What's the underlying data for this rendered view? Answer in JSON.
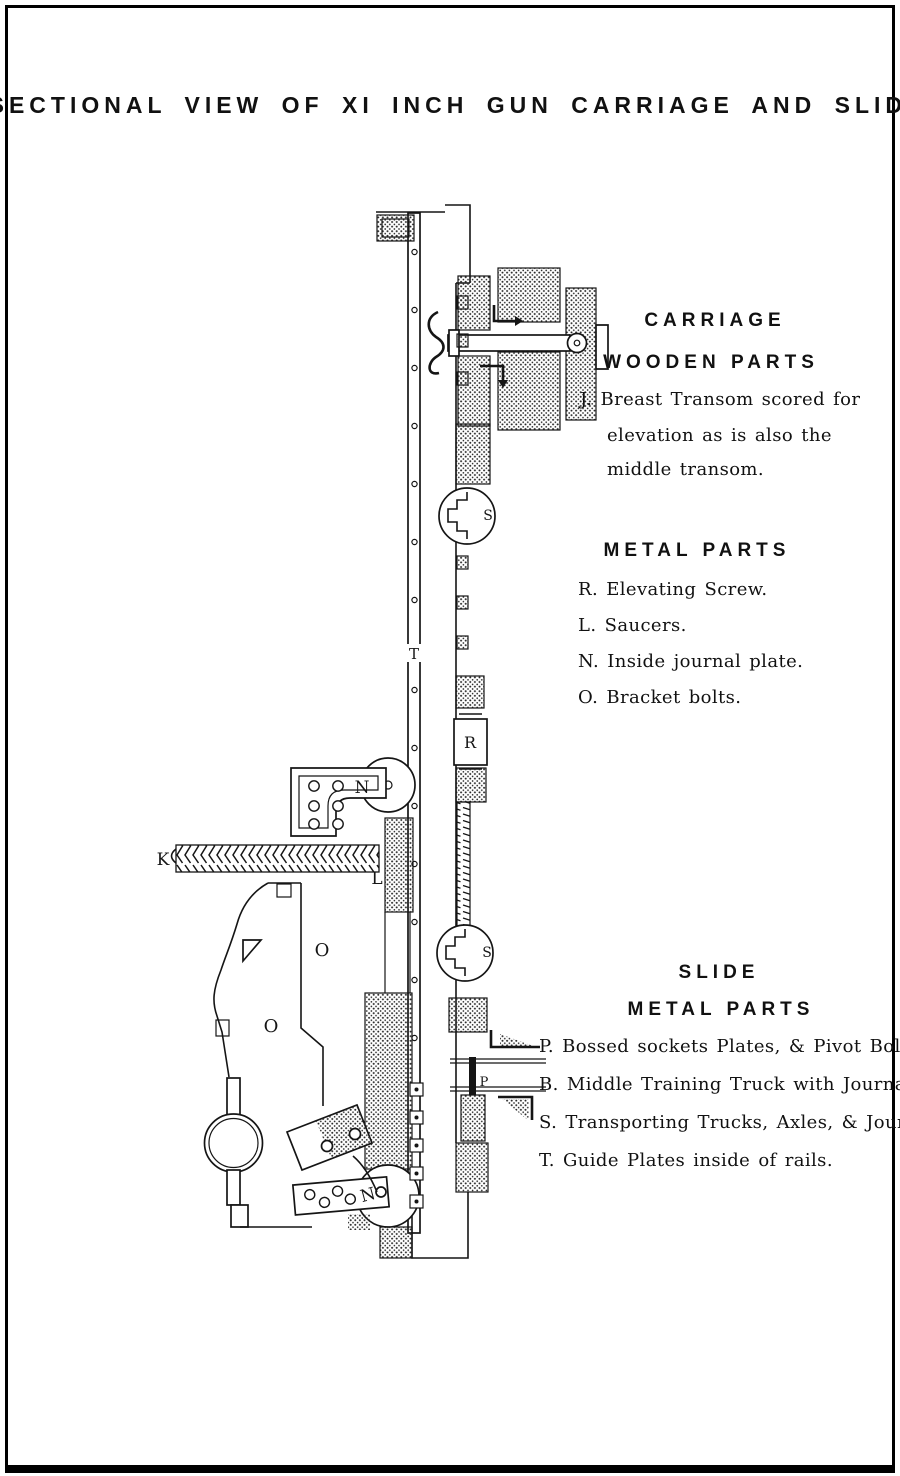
{
  "page": {
    "title": "SECTIONAL VIEW OF XI INCH GUN CARRIAGE AND SLIDE"
  },
  "legend": {
    "carriage_heading": "CARRIAGE",
    "wooden_parts_heading": "WOODEN PARTS",
    "item_j_line1": "J. Breast Transom scored for",
    "item_j_line2": "elevation as is also the",
    "item_j_line3": "middle transom.",
    "metal_parts_heading": "METAL PARTS",
    "item_r": "R. Elevating Screw.",
    "item_l": "L. Saucers.",
    "item_n": "N. Inside journal plate.",
    "item_o": "O. Bracket bolts.",
    "slide_heading": "SLIDE",
    "slide_metal_parts_heading": "METAL PARTS",
    "item_p": "P. Bossed sockets Plates, & Pivot Bolts.",
    "item_b": "B. Middle Training Truck with Journals.",
    "item_s": "S. Transporting Trucks, Axles, & Journals.",
    "item_t": "T. Guide Plates inside of rails."
  },
  "diagram": {
    "labels": {
      "t_rail": "T",
      "s_upper": "S",
      "s_lower": "S",
      "r_screw": "R",
      "n_upper": "N",
      "n_lower": "N",
      "k_screw": "K",
      "l_saucer": "L",
      "o_upper": "O",
      "o_lower": "O",
      "p_pivot": "P"
    }
  },
  "colors": {
    "ink": "#111111",
    "paper": "#ffffff"
  }
}
